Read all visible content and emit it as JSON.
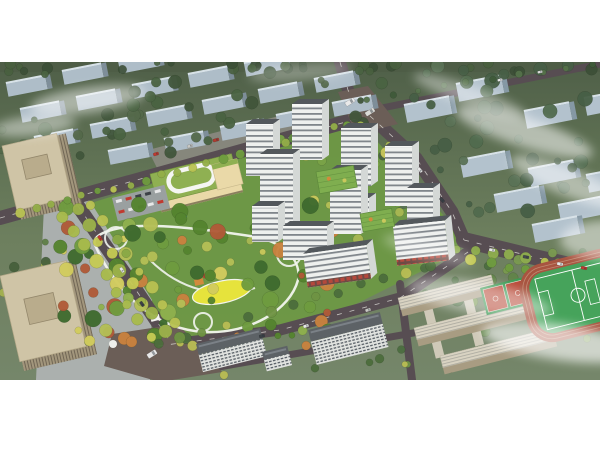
{
  "canvas": {
    "width": 600,
    "height": 450,
    "image_top": 62,
    "image_height": 318,
    "page_background": "#ffffff"
  },
  "palette": {
    "site_green": "#6d9845",
    "road": "#574d52",
    "road_dash": "#f5f5f0",
    "junction": "#6b5e57",
    "plaza": "#aeb2b2",
    "parking": "#9aa0a0",
    "north_parking": "#8d8b84",
    "school_roof": "#8fb052",
    "school_face": "#ead9a8",
    "loop_white": "#f5f6f2",
    "park_path": "#f2f4ee",
    "lawn_yellow": "#e6e33c",
    "pond_blue": "#4e8fb8",
    "play_orange": "#d28a3c",
    "play_red": "#b44633",
    "tower_face": "#eef0ee",
    "tower_side": "#d4d8d6",
    "tower_roof": "#53585c",
    "tower_parapet": "#f6f7f5",
    "green_roof": "#7fae4f",
    "green_roof_line": "#5e8a3c",
    "slab_roof": "#5d6266",
    "beige_roof": "#cfc4a6",
    "beige_inner": "#b9ac8c",
    "beige_face": "#a2967c",
    "beige_side": "#8f8268",
    "campus_face": "#a89c82",
    "connector": "#cfc9b8",
    "track_red": "#a85440",
    "track_lane": "#c08a72",
    "field_green": "#46a35b",
    "court_red": "#b84a38",
    "court_green": "#3e9a55",
    "cloud_white": "#ffffff",
    "block_face_left": "#aebdc8",
    "block_side_left": "#7e8e99",
    "block_face_right": "#b3c2cd",
    "block_side_right": "#8598a4",
    "block_roofline": "#d8e2e8",
    "bg_top_strip": "#4e5d46"
  },
  "site": {
    "outline": [
      [
        62,
        212
      ],
      [
        358,
        120
      ],
      [
        464,
        238
      ],
      [
        452,
        256
      ],
      [
        360,
        302
      ],
      [
        300,
        330
      ],
      [
        165,
        344
      ],
      [
        96,
        236
      ]
    ]
  },
  "plazas": [
    {
      "name": "left-plaza",
      "pts": [
        [
          44,
          206
        ],
        [
          88,
          198
        ],
        [
          152,
          300
        ],
        [
          150,
          380
        ],
        [
          36,
          380
        ]
      ],
      "color": "#aeb2b2",
      "op": 0.95
    },
    {
      "name": "north-parking",
      "pts": [
        [
          148,
          150
        ],
        [
          302,
          110
        ],
        [
          314,
          130
        ],
        [
          162,
          178
        ]
      ],
      "color": "#8d8b84",
      "op": 0.85
    }
  ],
  "junctions": [
    {
      "name": "top-junction",
      "pts": [
        [
          338,
          92
        ],
        [
          368,
          86
        ],
        [
          398,
          124
        ],
        [
          356,
          134
        ]
      ]
    },
    {
      "name": "bottom-junction",
      "pts": [
        [
          112,
          334
        ],
        [
          178,
          324
        ],
        [
          222,
          372
        ],
        [
          160,
          382
        ],
        [
          104,
          366
        ]
      ]
    }
  ],
  "roads": [
    {
      "name": "top-boundary-road",
      "pts": [
        [
          0,
          218
        ],
        [
          360,
          118
        ]
      ],
      "w": 14,
      "dash": true
    },
    {
      "name": "top-vertical-road",
      "pts": [
        [
          340,
          62
        ],
        [
          348,
          90
        ],
        [
          362,
          118
        ]
      ],
      "w": 12,
      "dash": true
    },
    {
      "name": "top-right-road",
      "pts": [
        [
          362,
          112
        ],
        [
          600,
          64
        ]
      ],
      "w": 7,
      "dash": false
    },
    {
      "name": "right-boundary-road",
      "pts": [
        [
          370,
          116
        ],
        [
          416,
          158
        ],
        [
          452,
          212
        ],
        [
          464,
          240
        ]
      ],
      "w": 13,
      "dash": true
    },
    {
      "name": "southeast-boulevard",
      "pts": [
        [
          464,
          240
        ],
        [
          530,
          256
        ],
        [
          600,
          272
        ]
      ],
      "w": 16,
      "dash": true
    },
    {
      "name": "left-boulevard",
      "pts": [
        [
          78,
          206
        ],
        [
          136,
          290
        ],
        [
          168,
          338
        ]
      ],
      "w": 14,
      "dash": true
    },
    {
      "name": "bottom-road",
      "pts": [
        [
          158,
          346
        ],
        [
          280,
          330
        ],
        [
          400,
          298
        ],
        [
          468,
          252
        ]
      ],
      "w": 11,
      "dash": true
    },
    {
      "name": "bottom-thin-road",
      "pts": [
        [
          190,
          372
        ],
        [
          340,
          346
        ],
        [
          430,
          330
        ]
      ],
      "w": 7,
      "dash": false
    },
    {
      "name": "campus-road",
      "pts": [
        [
          400,
          284
        ],
        [
          412,
          380
        ]
      ],
      "w": 8,
      "dash": false
    }
  ],
  "bg_blocks": {
    "left": {
      "w": 40,
      "h": 13,
      "rot": -11,
      "positions": [
        [
          6,
          84
        ],
        [
          62,
          72
        ],
        [
          118,
          61
        ],
        [
          20,
          110
        ],
        [
          76,
          98
        ],
        [
          132,
          86
        ],
        [
          188,
          75
        ],
        [
          244,
          64
        ],
        [
          34,
          138
        ],
        [
          90,
          126
        ],
        [
          146,
          114
        ],
        [
          202,
          102
        ],
        [
          258,
          91
        ],
        [
          314,
          80
        ],
        [
          108,
          152
        ],
        [
          164,
          140
        ],
        [
          220,
          128
        ],
        [
          276,
          116
        ],
        [
          332,
          104
        ]
      ]
    },
    "right": {
      "w": 46,
      "h": 17,
      "rot": -11,
      "positions": [
        [
          404,
          106
        ],
        [
          456,
          85
        ],
        [
          524,
          112
        ],
        [
          584,
          99
        ],
        [
          460,
          161
        ],
        [
          528,
          170
        ],
        [
          494,
          196
        ],
        [
          558,
          206
        ],
        [
          586,
          176
        ],
        [
          532,
          226
        ]
      ]
    }
  },
  "tree_clusters": [
    {
      "name": "bg-top",
      "rect": [
        0,
        62,
        600,
        10
      ],
      "count": 26,
      "rmin": 3,
      "rmax": 6,
      "palette": [
        "#3c4f37",
        "#49603f"
      ],
      "seed": 11,
      "op": 0.9
    },
    {
      "name": "bg-left",
      "rect": [
        0,
        66,
        385,
        92
      ],
      "count": 46,
      "rmin": 3,
      "rmax": 7,
      "palette": [
        "#41563b",
        "#54694a",
        "#4a6342"
      ],
      "seed": 23,
      "op": 0.95
    },
    {
      "name": "bg-right",
      "rect": [
        398,
        64,
        202,
        150
      ],
      "count": 40,
      "rmin": 3,
      "rmax": 8,
      "palette": [
        "#475f46",
        "#5a7256",
        "#516b4e"
      ],
      "seed": 31,
      "op": 0.95
    },
    {
      "name": "left-edge",
      "rect": [
        0,
        200,
        48,
        176
      ],
      "count": 14,
      "rmin": 3,
      "rmax": 6,
      "palette": [
        "#46603c",
        "#5f7f46",
        "#a5b250"
      ],
      "seed": 83,
      "op": 0.95
    },
    {
      "name": "courtyard",
      "rect": [
        250,
        132,
        185,
        120
      ],
      "count": 24,
      "rmin": 2.5,
      "rmax": 5.5,
      "palette": [
        "#5d8a3c",
        "#7aa348",
        "#a9b853",
        "#c9c85c"
      ],
      "seed": 41,
      "op": 0.95
    },
    {
      "name": "park",
      "rect": [
        60,
        204,
        272,
        142
      ],
      "count": 90,
      "rmin": 3,
      "rmax": 8.5,
      "palette": [
        "#3f6b2f",
        "#55842f",
        "#6f9c3f",
        "#8fb04e",
        "#b4bf56",
        "#d2cc5e",
        "#c9823f",
        "#b05a38"
      ],
      "seed": 53,
      "op": 0.96
    },
    {
      "name": "campus-trees",
      "rect": [
        382,
        248,
        218,
        126
      ],
      "count": 26,
      "rmin": 3,
      "rmax": 6.5,
      "palette": [
        "#4c6d40",
        "#628449",
        "#7a9a50"
      ],
      "seed": 61,
      "op": 0.95
    },
    {
      "name": "bottom-strip",
      "rect": [
        168,
        332,
        240,
        44
      ],
      "count": 16,
      "rmin": 3,
      "rmax": 6,
      "palette": [
        "#4c6d3c",
        "#6f9346",
        "#b9bd54"
      ],
      "seed": 71,
      "op": 0.95
    }
  ],
  "tree_lines": [
    {
      "name": "top-road-trees",
      "from": [
        20,
        214
      ],
      "to": [
        348,
        124
      ],
      "count": 22,
      "r": 4,
      "palette": [
        "#b9c252",
        "#94ae48",
        "#6f9c3f"
      ],
      "seed": 5
    },
    {
      "name": "left-blvd-row1",
      "from": [
        64,
        216
      ],
      "to": [
        150,
        336
      ],
      "count": 9,
      "r": 5.5,
      "palette": [
        "#c6cb54",
        "#a8bb4c"
      ],
      "seed": 6
    },
    {
      "name": "left-blvd-row2",
      "from": [
        78,
        210
      ],
      "to": [
        164,
        330
      ],
      "count": 9,
      "r": 5.5,
      "palette": [
        "#c6cb54",
        "#9cb24a"
      ],
      "seed": 7
    },
    {
      "name": "left-blvd-row3",
      "from": [
        92,
        204
      ],
      "to": [
        176,
        322
      ],
      "count": 8,
      "r": 5,
      "palette": [
        "#b9c252",
        "#8aa846"
      ],
      "seed": 8
    },
    {
      "name": "right-road-trees",
      "from": [
        360,
        126
      ],
      "to": [
        446,
        224
      ],
      "count": 8,
      "r": 4.5,
      "palette": [
        "#c9c85c",
        "#a9b853"
      ],
      "seed": 9
    },
    {
      "name": "se-blvd-row1",
      "from": [
        458,
        248
      ],
      "to": [
        596,
        270
      ],
      "count": 9,
      "r": 5,
      "palette": [
        "#b9c252",
        "#8fae4e"
      ],
      "seed": 10
    },
    {
      "name": "se-blvd-row2",
      "from": [
        472,
        258
      ],
      "to": [
        596,
        288
      ],
      "count": 8,
      "r": 5,
      "palette": [
        "#6f9c3f",
        "#c6cb54"
      ],
      "seed": 12
    },
    {
      "name": "bottom-road-trees",
      "from": [
        158,
        344
      ],
      "to": [
        430,
        266
      ],
      "count": 13,
      "r": 4.5,
      "palette": [
        "#6f9343",
        "#b9bd54",
        "#4c6d3c"
      ],
      "seed": 13
    },
    {
      "name": "top-right-road-trees",
      "from": [
        368,
        98
      ],
      "to": [
        592,
        64
      ],
      "count": 10,
      "r": 3,
      "palette": [
        "#3f5a3a",
        "#55714a"
      ],
      "seed": 14
    }
  ],
  "school": {
    "x": 150,
    "y": 174,
    "rot": -14,
    "w": 84,
    "roof_h": 30,
    "face_h": 12,
    "loop": {
      "x": 16,
      "y": 4,
      "w": 46,
      "h": 20,
      "r": 10
    },
    "wing": {
      "x": 62,
      "y": 6,
      "w": 26,
      "h": 26
    },
    "parking": {
      "x": 112,
      "y": 198,
      "w": 54,
      "h": 24,
      "rot": -14
    }
  },
  "offices": [
    {
      "name": "office-tower-north",
      "x": 2,
      "y": 146,
      "rot": -13,
      "roof_w": 56,
      "roof_h": 66,
      "inner": [
        16,
        18,
        26,
        20
      ]
    },
    {
      "name": "office-tower-south",
      "x": 0,
      "y": 276,
      "rot": -13,
      "roof_w": 68,
      "roof_h": 88,
      "inner": [
        18,
        28,
        30,
        26
      ]
    }
  ],
  "park": {
    "loop_path": "M 95,245 C 120,300 160,330 205,332 C 250,334 290,310 298,280 C 302,258 280,240 250,236 C 210,230 150,222 120,228 C 100,232 92,238 95,245 Z",
    "inner_path": "M 150,260 C 180,290 220,300 255,288",
    "circles": [
      [
        116,
        238,
        11
      ],
      [
        289,
        254,
        12
      ],
      [
        203,
        322,
        9
      ]
    ],
    "lawn": {
      "cx": 222,
      "cy": 292,
      "rx": 30,
      "ry": 11,
      "rot": -12
    },
    "features": {
      "pavilion": [
        150,
        316,
        9,
        6,
        -14
      ],
      "tent": [
        113,
        344,
        4
      ],
      "play_rect": [
        194,
        280,
        9,
        6,
        -12
      ],
      "play_dot": [
        205,
        276,
        2.5
      ],
      "pond": [
        184,
        216,
        3
      ]
    }
  },
  "towers": [
    {
      "x": 246,
      "y": 124,
      "w": 27,
      "h": 52
    },
    {
      "x": 292,
      "y": 104,
      "w": 30,
      "h": 56
    },
    {
      "x": 341,
      "y": 128,
      "w": 30,
      "h": 58
    },
    {
      "x": 260,
      "y": 154,
      "w": 33,
      "h": 76
    },
    {
      "x": 330,
      "y": 170,
      "w": 31,
      "h": 64
    },
    {
      "x": 385,
      "y": 146,
      "w": 27,
      "h": 60
    },
    {
      "x": 407,
      "y": 188,
      "w": 26,
      "h": 50
    },
    {
      "x": 252,
      "y": 206,
      "w": 26,
      "h": 36
    },
    {
      "x": 283,
      "y": 226,
      "w": 44,
      "h": 34
    },
    {
      "x": 345,
      "y": 198,
      "w": 24,
      "h": 28
    },
    {
      "x": 303,
      "y": 254,
      "w": 64,
      "h": 34,
      "shops": true,
      "rot": -8
    },
    {
      "x": 393,
      "y": 226,
      "w": 52,
      "h": 40,
      "shops": true,
      "rot": -6
    }
  ],
  "green_roofs": [
    {
      "x": 316,
      "y": 172,
      "w": 38,
      "h": 22,
      "rot": -10
    },
    {
      "x": 360,
      "y": 214,
      "w": 32,
      "h": 18,
      "rot": -10
    }
  ],
  "bottom_slabs": [
    {
      "x": 196,
      "y": 344,
      "rot": -14,
      "w": 66,
      "roof_h": 11,
      "face_h": 18
    },
    {
      "x": 308,
      "y": 330,
      "rot": -14,
      "w": 74,
      "roof_h": 12,
      "face_h": 24
    },
    {
      "x": 262,
      "y": 352,
      "rot": -14,
      "w": 26,
      "roof_h": 8,
      "face_h": 12
    }
  ],
  "campus": {
    "bars": [
      {
        "x": 398,
        "y": 298,
        "l": 96
      },
      {
        "x": 414,
        "y": 328,
        "l": 112
      },
      {
        "x": 440,
        "y": 356,
        "l": 116
      }
    ],
    "bar_rot": -14,
    "roof_h": 12,
    "face_h": 7,
    "connectors": [
      {
        "x": 470,
        "y": 288,
        "l": 58
      },
      {
        "x": 432,
        "y": 306,
        "l": 52
      }
    ],
    "courts": {
      "x": 480,
      "y": 288,
      "rot": -14,
      "w": 48,
      "h": 28
    },
    "field": {
      "x": 514,
      "y": 270,
      "rot": -14,
      "w": 112,
      "h": 80
    }
  },
  "vehicles": [
    {
      "x": 350,
      "y": 102,
      "l": 10,
      "h": 4.5,
      "rot": -32,
      "c": "#e9e9e9"
    },
    {
      "x": 370,
      "y": 112,
      "l": 10,
      "h": 4.5,
      "rot": -32,
      "c": "#dadad6"
    },
    {
      "x": 216,
      "y": 140,
      "l": 6,
      "h": 3,
      "rot": -16,
      "c": "#b03a2e"
    },
    {
      "x": 190,
      "y": 146,
      "l": 5.5,
      "h": 3,
      "rot": -16,
      "c": "#c8c8c4"
    },
    {
      "x": 156,
      "y": 154,
      "l": 5.5,
      "h": 3,
      "rot": -16,
      "c": "#c03a30"
    },
    {
      "x": 420,
      "y": 170,
      "l": 5.5,
      "h": 3,
      "rot": 49,
      "c": "#e8e8e8"
    },
    {
      "x": 442,
      "y": 200,
      "l": 5.5,
      "h": 3,
      "rot": 49,
      "c": "#3c4146"
    },
    {
      "x": 492,
      "y": 250,
      "l": 6,
      "h": 3,
      "rot": 11,
      "c": "#e8e8e8"
    },
    {
      "x": 526,
      "y": 257,
      "l": 6,
      "h": 3,
      "rot": 11,
      "c": "#454a4e"
    },
    {
      "x": 560,
      "y": 264,
      "l": 6,
      "h": 3,
      "rot": 11,
      "c": "#e8e8e8"
    },
    {
      "x": 584,
      "y": 268,
      "l": 6,
      "h": 3,
      "rot": 11,
      "c": "#c03a30"
    },
    {
      "x": 500,
      "y": 80,
      "l": 5,
      "h": 2.5,
      "rot": -11,
      "c": "#e8e8e8"
    },
    {
      "x": 540,
      "y": 72,
      "l": 5,
      "h": 2.5,
      "rot": -11,
      "c": "#dddddd"
    },
    {
      "x": 100,
      "y": 238,
      "l": 5.5,
      "h": 3,
      "rot": 54,
      "c": "#c03a30"
    },
    {
      "x": 122,
      "y": 270,
      "l": 5.5,
      "h": 3,
      "rot": 54,
      "c": "#e8e8e8"
    },
    {
      "x": 142,
      "y": 304,
      "l": 5.5,
      "h": 3,
      "rot": 54,
      "c": "#3c4146"
    },
    {
      "x": 262,
      "y": 336,
      "l": 5.5,
      "h": 3,
      "rot": -14,
      "c": "#3c4146"
    },
    {
      "x": 306,
      "y": 326,
      "l": 5.5,
      "h": 3,
      "rot": -16,
      "c": "#e8e8e8"
    },
    {
      "x": 368,
      "y": 310,
      "l": 5.5,
      "h": 3,
      "rot": -18,
      "c": "#c8c8c4"
    },
    {
      "x": 152,
      "y": 354,
      "l": 10,
      "h": 5,
      "rot": -32,
      "c": "#e9e9e9"
    }
  ],
  "clouds": [
    {
      "cx": 88,
      "cy": 100,
      "rx": 58,
      "ry": 13,
      "rot": -8,
      "op": 0.5
    },
    {
      "cx": 34,
      "cy": 126,
      "rx": 42,
      "ry": 10,
      "rot": -6,
      "op": 0.45
    },
    {
      "cx": 300,
      "cy": 72,
      "rx": 52,
      "ry": 9,
      "rot": -5,
      "op": 0.3
    },
    {
      "cx": 470,
      "cy": 96,
      "rx": 60,
      "ry": 10,
      "rot": 20,
      "op": 0.4
    },
    {
      "cx": 524,
      "cy": 132,
      "rx": 72,
      "ry": 15,
      "rot": 18,
      "op": 0.55
    },
    {
      "cx": 568,
      "cy": 182,
      "rx": 62,
      "ry": 14,
      "rot": 22,
      "op": 0.5
    },
    {
      "cx": 428,
      "cy": 250,
      "rx": 46,
      "ry": 10,
      "rot": 15,
      "op": 0.3
    },
    {
      "cx": 480,
      "cy": 298,
      "rx": 72,
      "ry": 16,
      "rot": 10,
      "op": 0.45
    },
    {
      "cx": 560,
      "cy": 342,
      "rx": 78,
      "ry": 18,
      "rot": 8,
      "op": 0.65
    },
    {
      "cx": 610,
      "cy": 240,
      "rx": 50,
      "ry": 20,
      "rot": 0,
      "op": 0.5
    }
  ]
}
